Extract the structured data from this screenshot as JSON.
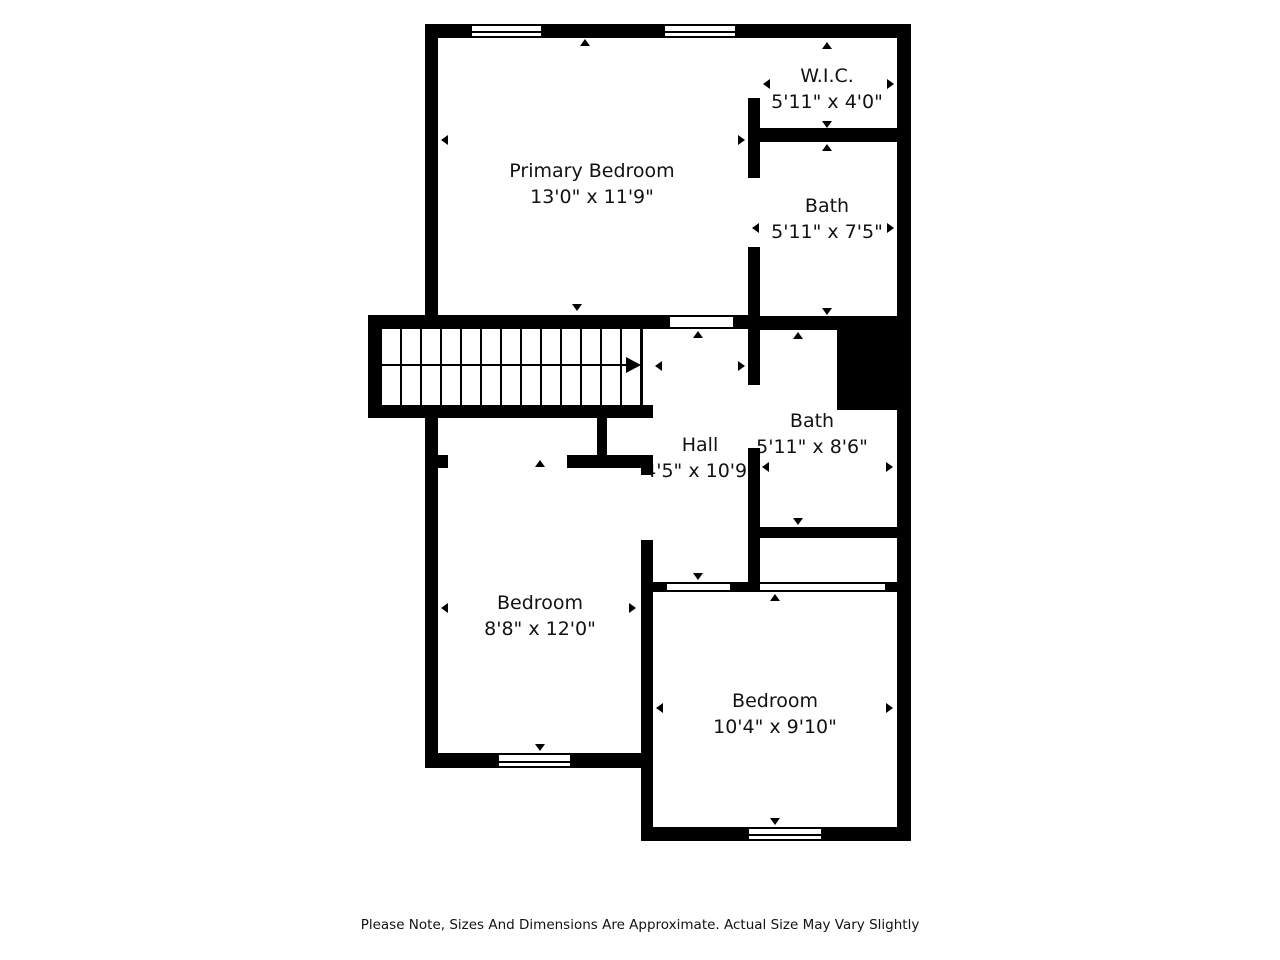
{
  "note": "Please Note, Sizes And Dimensions Are Approximate. Actual Size May Vary Slightly",
  "rooms": {
    "primary_bedroom": {
      "name": "Primary Bedroom",
      "dims": "13'0\" x 11'9\""
    },
    "wic": {
      "name": "W.I.C.",
      "dims": "5'11\" x 4'0\""
    },
    "bath_upper": {
      "name": "Bath",
      "dims": "5'11\" x 7'5\""
    },
    "bath_lower": {
      "name": "Bath",
      "dims": "5'11\" x 8'6\""
    },
    "hall": {
      "name": "Hall",
      "dims": "4'5\" x 10'9\""
    },
    "bedroom_left": {
      "name": "Bedroom",
      "dims": "8'8\" x 12'0\""
    },
    "bedroom_right": {
      "name": "Bedroom",
      "dims": "10'4\" x 9'10\""
    }
  },
  "colors": {
    "wall": "#000000",
    "background": "#ffffff"
  }
}
